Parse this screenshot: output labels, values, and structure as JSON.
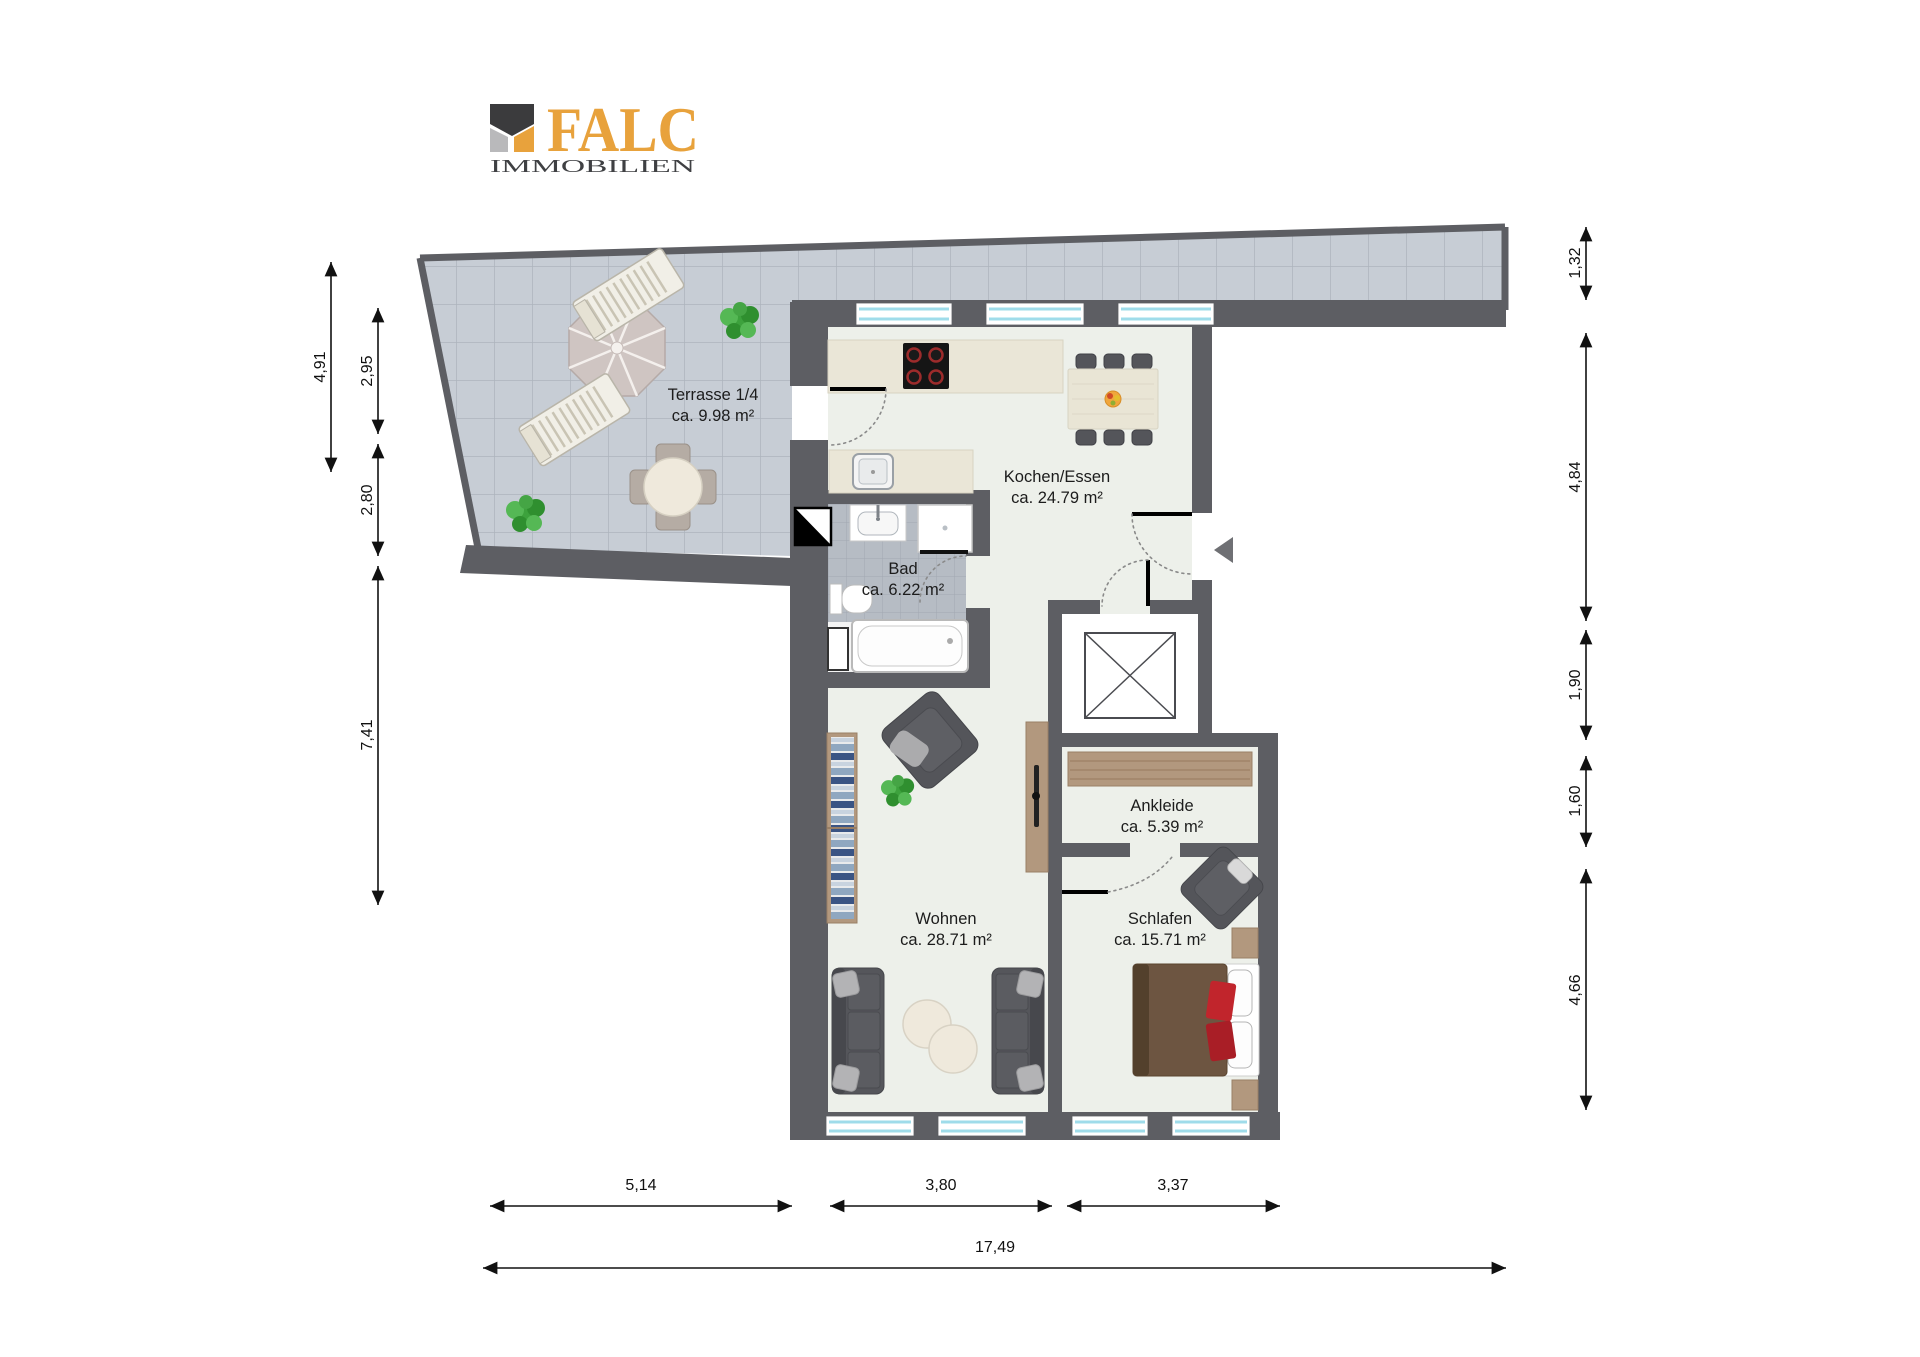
{
  "logo": {
    "brand": "FALC",
    "subtitle": "IMMOBILIEN",
    "accent_color": "#E8A23C",
    "dark_color": "#3B3B3D",
    "gray_color": "#B9B9BB"
  },
  "rooms": [
    {
      "name": "Terrasse 1/4",
      "area": "ca. 9.98 m²"
    },
    {
      "name": "Kochen/Essen",
      "area": "ca. 24.79 m²"
    },
    {
      "name": "Bad",
      "area": "ca. 6.22 m²"
    },
    {
      "name": "Ankleide",
      "area": "ca. 5.39 m²"
    },
    {
      "name": "Wohnen",
      "area": "ca. 28.71 m²"
    },
    {
      "name": "Schlafen",
      "area": "ca. 15.71 m²"
    }
  ],
  "dims": [
    "4,91",
    "2,95",
    "2,80",
    "7,41",
    "1,32",
    "4,84",
    "1,90",
    "1,60",
    "4,66",
    "5,14",
    "3,80",
    "3,37",
    "17,49"
  ],
  "colors": {
    "wall": "#5d5e63",
    "terrace_tile": "#c7cdd5",
    "terrace_grid": "#adb4bd",
    "room_floor": "#edf0ea",
    "bath_tile": "#b6bcc4",
    "window_glass": "#9fdcea",
    "furniture_dark": "#54555a",
    "furniture_wood": "#b2987e",
    "bed_brown": "#6d5541",
    "accent_red": "#c1252c",
    "plant_green": "#3da23d",
    "counter_beige": "#eae6d7"
  }
}
